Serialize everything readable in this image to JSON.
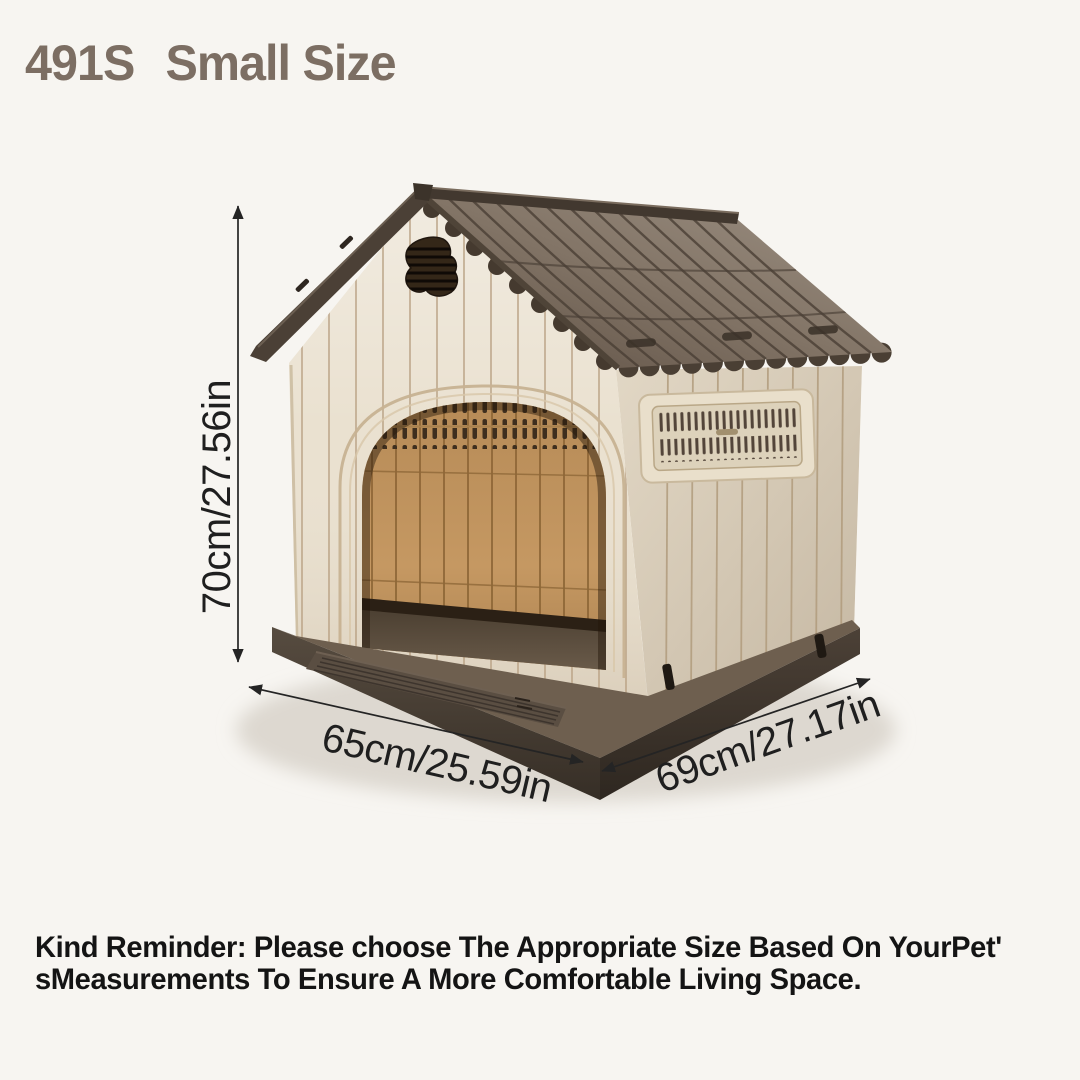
{
  "header": {
    "model": "491S",
    "size_label": "Small Size"
  },
  "dimensions": {
    "height_label": "70cm/27.56in",
    "width_label": "65cm/25.59in",
    "depth_label": "69cm/27.17in"
  },
  "footer": {
    "reminder_lines": [
      "Kind Reminder: Please choose The Appropriate Size Based On YourPet'",
      "sMeasurements To Ensure A More Comfortable Living Space."
    ]
  },
  "colors": {
    "background": "#f7f5f1",
    "title": "#7c6e63",
    "dimension_text": "#1f1f1f",
    "footer_text": "#141414",
    "roof": "#6b5d50",
    "wall": "#eae1d0",
    "door_interior": "#c59862",
    "base": "#4b4138"
  }
}
